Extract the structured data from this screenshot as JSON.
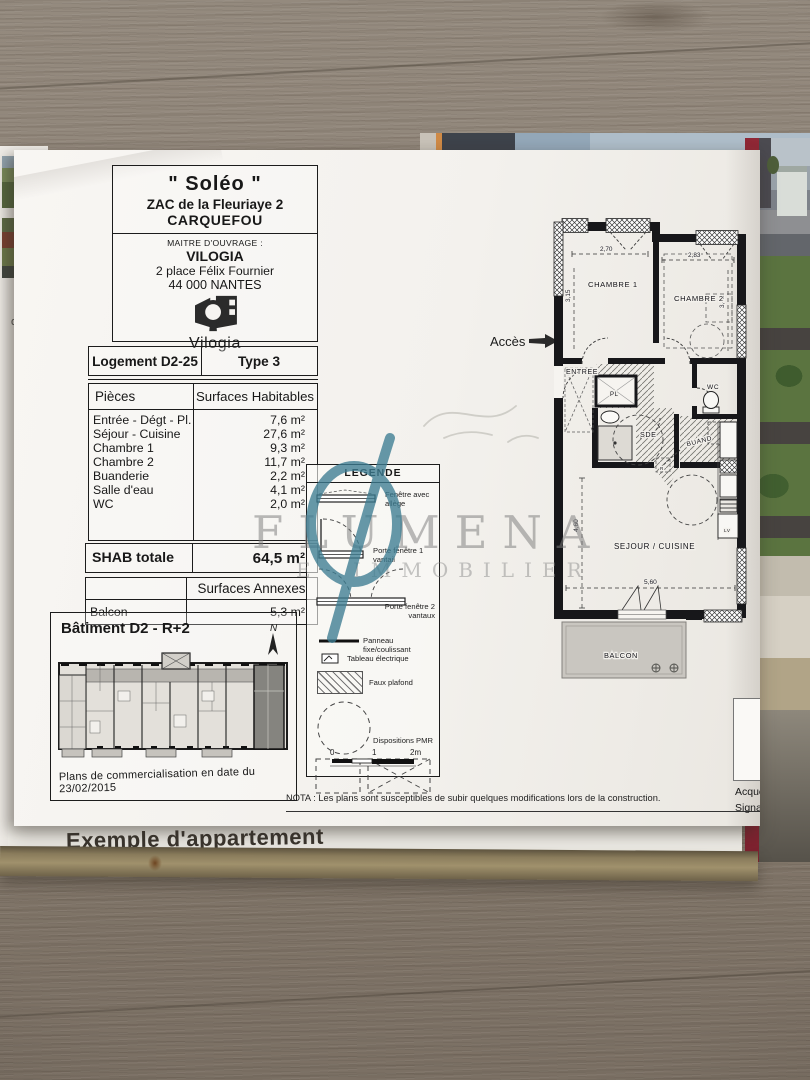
{
  "page": {
    "bottom_text": "Exemple d'appartement"
  },
  "left_page": {
    "f1": "ose de",
    "f2": "est",
    "f3": "e",
    "f4": "nte",
    "f5": "ges,"
  },
  "header": {
    "title": "\" Soléo \"",
    "subtitle1": "ZAC de la Fleuriaye 2",
    "subtitle2": "CARQUEFOU",
    "maitre_label": "MAITRE D'OUVRAGE :",
    "maitre_name": "VILOGIA",
    "maitre_addr1": "2 place Félix Fournier",
    "maitre_addr2": "44 000 NANTES",
    "logo_text": "Vilogia"
  },
  "unit": {
    "lot": "Logement D2-25",
    "type": "Type 3"
  },
  "surfaces": {
    "col_pieces": "Pièces",
    "col_hab": "Surfaces Habitables",
    "rows": [
      {
        "label": "Entrée - Dégt - Pl.",
        "value": "7,6 m²"
      },
      {
        "label": "Séjour - Cuisine",
        "value": "27,6 m²"
      },
      {
        "label": "Chambre 1",
        "value": "9,3 m²"
      },
      {
        "label": "Chambre 2",
        "value": "11,7 m²"
      },
      {
        "label": "Buanderie",
        "value": "2,2 m²"
      },
      {
        "label": "Salle d'eau",
        "value": "4,1 m²"
      },
      {
        "label": "WC",
        "value": "2,0 m²"
      }
    ],
    "shab_label": "SHAB totale",
    "shab_value": "64,5 m²",
    "annexes_title": "Surfaces Annexes",
    "annexe_label": "Balcon",
    "annexe_value": "5,3 m²"
  },
  "batiment": {
    "title": "Bâtiment D2 - R+2",
    "north": "N",
    "caption": "Plans de commercialisation en date du 23/02/2015"
  },
  "legende": {
    "title": "LEGENDE",
    "items": [
      "Fenêtre avec allège",
      "Porte fenêtre 1 vantail",
      "Porte fenêtre 2 vantaux",
      "Panneau fixe/coulissant",
      "Tableau électrique",
      "Faux plafond",
      "Dispositions PMR"
    ],
    "scale_0": "0",
    "scale_1": "1",
    "scale_2": "2m"
  },
  "plan": {
    "acces": "Accès",
    "chambre1": "CHAMBRE 1",
    "chambre2": "CHAMBRE 2",
    "entree": "ENTREE",
    "pl": "PL",
    "wc": "WC",
    "sde": "SDE",
    "buand": "BUAND",
    "sejour": "SEJOUR / CUISINE",
    "balcon": "BALCON",
    "lv": "LV",
    "r": "R",
    "dim_ch1_w": "2,70",
    "dim_ch2_w": "2,83",
    "dim_ch1_h": "3,15",
    "dim_ch2_h": "3,42",
    "dim_sej_h": "4,60",
    "dim_sej_w": "5,60"
  },
  "nota": "NOTA : Les plans sont susceptibles de subir quelques modifications lors de la construction.",
  "signature": {
    "line1": "Acquéreur",
    "line2": "Signature"
  },
  "watermark": {
    "line1": "FLUMENA",
    "line2": "E IMMOBILIER",
    "accent": "#3d7d92"
  }
}
